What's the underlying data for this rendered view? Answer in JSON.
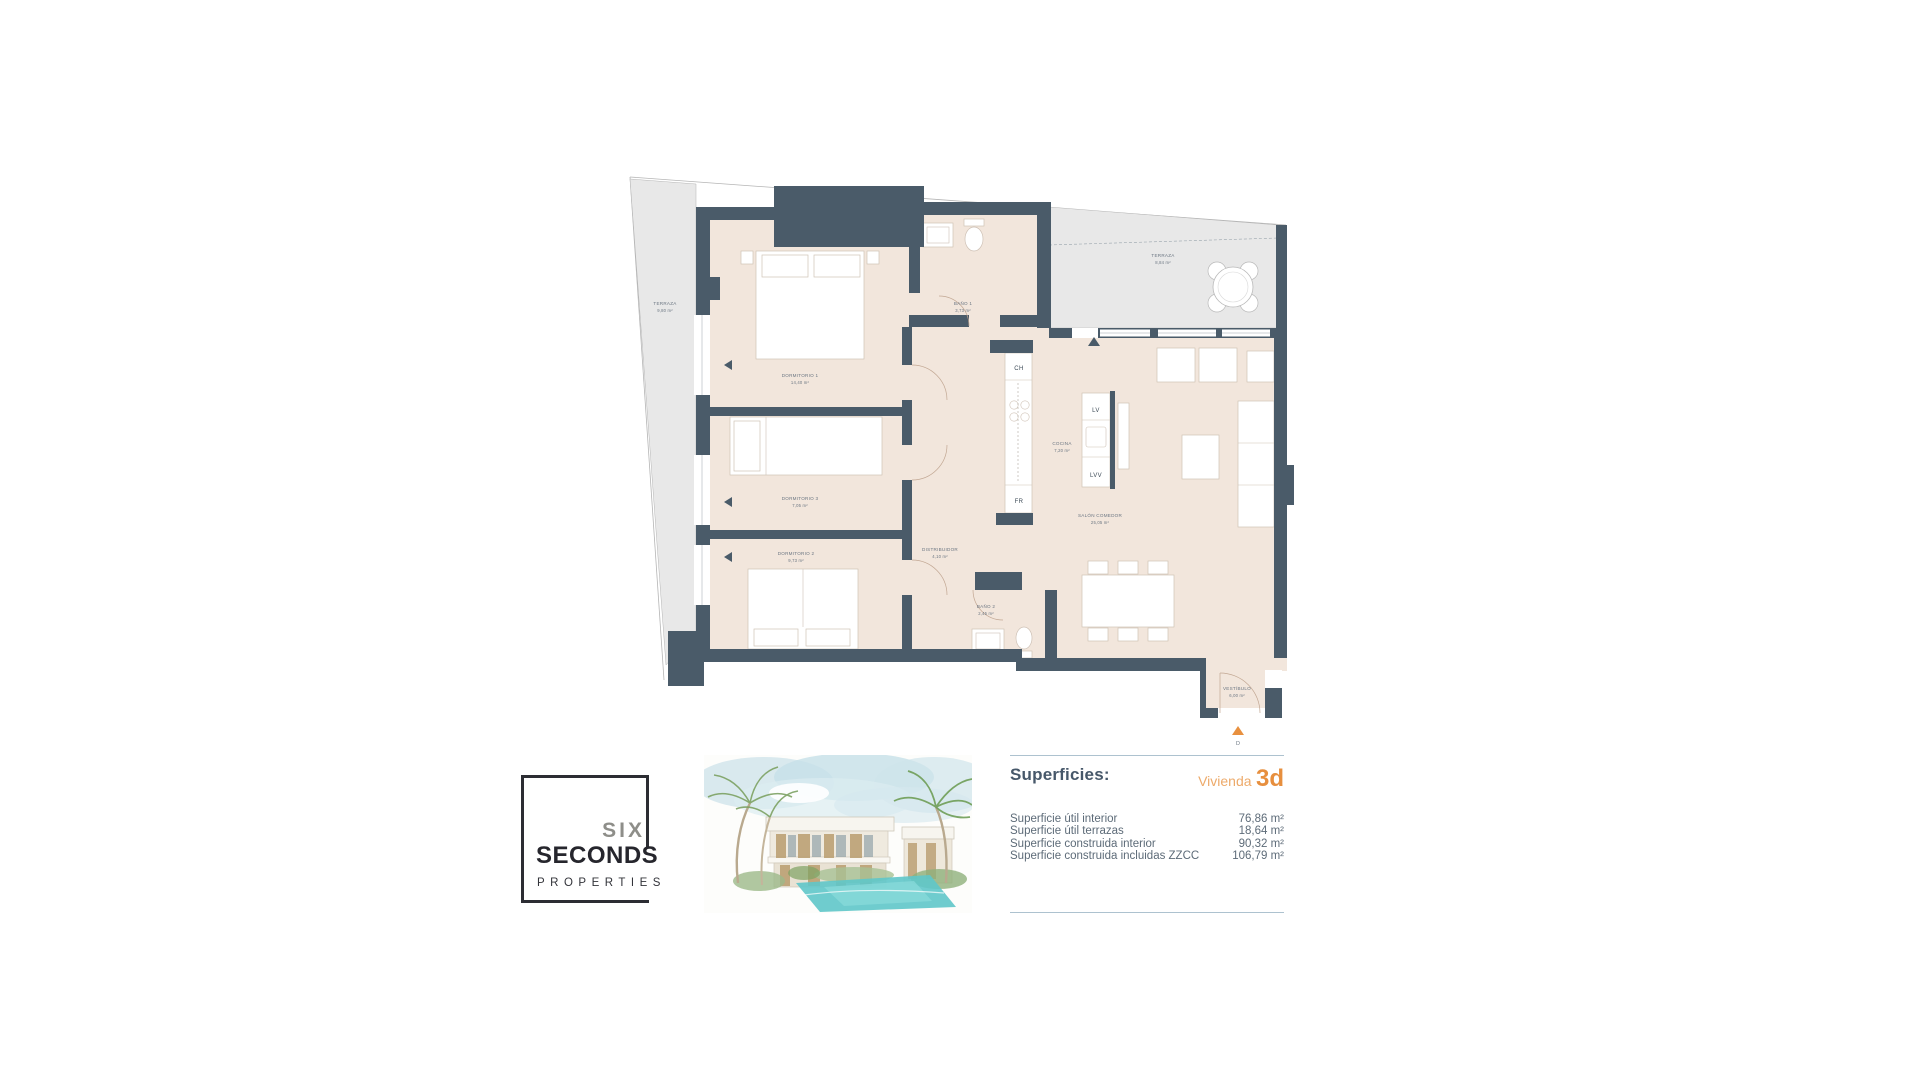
{
  "colors": {
    "wall": "#4a5b69",
    "floor": "#f2e6dc",
    "terrace": "#e8e8e8",
    "accent_orange": "#e8903f",
    "accent_orange_light": "#edaa6a",
    "slate_text": "#47586a",
    "body_text": "#5d6b78",
    "rule": "#adc2cf"
  },
  "plan": {
    "rooms": [
      {
        "name": "TERRAZA",
        "area": "9,80 m²"
      },
      {
        "name": "TERRAZA",
        "area": "8,84 m²"
      },
      {
        "name": "DORMITORIO 1",
        "area": "14,40 m²"
      },
      {
        "name": "BAÑO 1",
        "area": "3,73 m²"
      },
      {
        "name": "DORMITORIO 3",
        "area": "7,05 m²"
      },
      {
        "name": "DORMITORIO 2",
        "area": "9,73 m²"
      },
      {
        "name": "DISTRIBUIDOR",
        "area": "4,10 m²"
      },
      {
        "name": "BAÑO 2",
        "area": "2,45 m²"
      },
      {
        "name": "COCINA",
        "area": "7,20 m²"
      },
      {
        "name": "SALÓN COMEDOR",
        "area": "25,05 m²"
      },
      {
        "name": "VESTÍBULO",
        "area": "6,00 m²"
      }
    ],
    "appliances": {
      "ch": "CH",
      "fr": "FR",
      "lv": "LV",
      "lvv": "LVV"
    },
    "entrance_marker": "D"
  },
  "logo": {
    "word1": "SIX",
    "word2": "SECONDS",
    "word3": "PROPERTIES"
  },
  "summary": {
    "title": "Superficies:",
    "unit_label": "Vivienda",
    "unit_code": "3d",
    "rows": [
      {
        "label": "Superficie útil interior",
        "value": "76,86 m²"
      },
      {
        "label": "Superficie útil terrazas",
        "value": "18,64 m²"
      },
      {
        "label": "Superficie construida interior",
        "value": "90,32 m²"
      },
      {
        "label": "Superficie construida incluidas ZZCC",
        "value": "106,79 m²"
      }
    ]
  }
}
